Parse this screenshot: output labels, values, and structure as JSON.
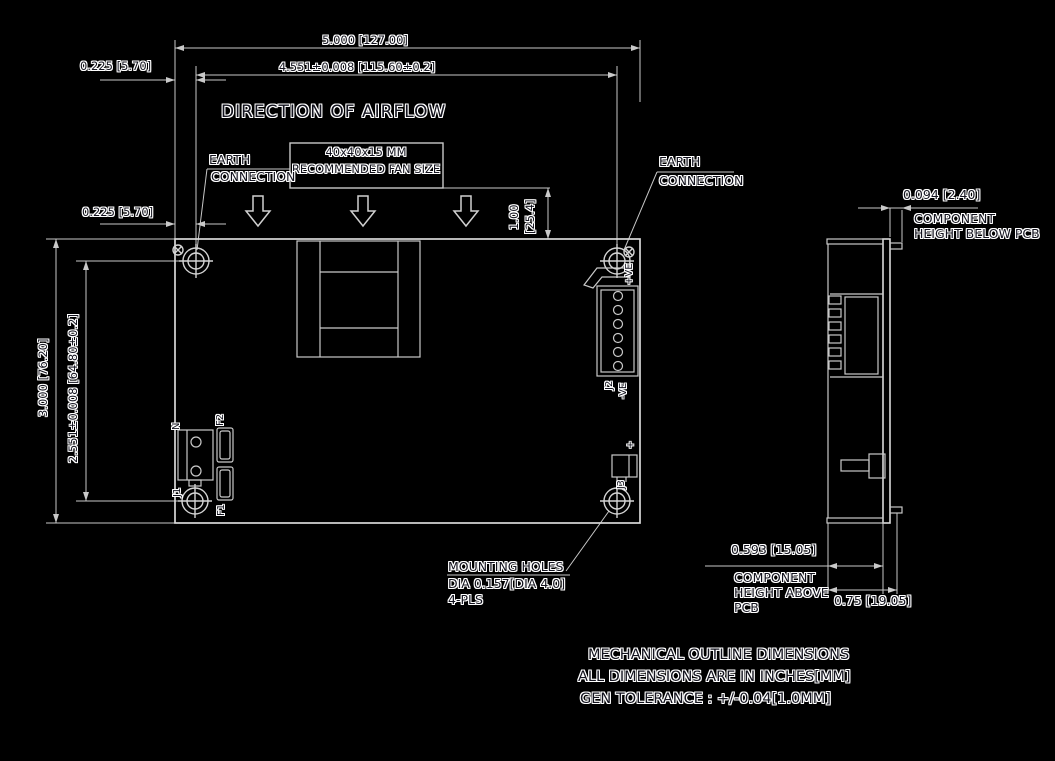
{
  "colors": {
    "background": "#000000",
    "line": "#c9c9c9",
    "outline": "#d9d9d9",
    "text_core": "#14141f",
    "text_halo": "#ffffff"
  },
  "top_view": {
    "airflow_title": "DIRECTION OF AIRFLOW",
    "fan_note": {
      "line1": "40x40x15 MM",
      "line2": "RECOMMENDED FAN SIZE"
    },
    "earth_left": {
      "line1": "EARTH",
      "line2": "CONNECTION"
    },
    "earth_right": {
      "line1": "EARTH",
      "line2": "CONNECTION"
    },
    "refdes": {
      "n": "N",
      "f1": "F1",
      "f2": "F2",
      "j1": "J1",
      "j2": "J2",
      "j3": "J3",
      "pos": "+VE",
      "neg": "-VE",
      "plus": "+"
    }
  },
  "dimensions": {
    "overall_width": "5.000 [127.00]",
    "hole_pitch_width": "4.551±0.008 [115.60±0.2]",
    "hole_offset_top": "0.225 [5.70]",
    "hole_offset_left": "0.225 [5.70]",
    "overall_height": "3.000 [76.20]",
    "hole_pitch_height": "2.551±0.008 [64.80±0.2]",
    "fan_height_in": "1.00",
    "fan_height_mm": "[25.4]",
    "height_below_pcb": "0.094 [2.40]",
    "height_above_pcb": "0.593 [15.05]",
    "overall_thickness": "0.75 [19.05]"
  },
  "callouts": {
    "height_below_label": {
      "line1": "COMPONENT",
      "line2": "HEIGHT BELOW PCB"
    },
    "height_above_label": {
      "line1": "COMPONENT",
      "line2": "HEIGHT ABOVE",
      "line3": "PCB"
    },
    "mounting_holes": {
      "line1": "MOUNTING HOLES",
      "line2": "DIA 0.157[DIA 4.0]",
      "line3": "4-PLS"
    }
  },
  "notes": {
    "line1": "MECHANICAL OUTLINE DIMENSIONS",
    "line2": "ALL DIMENSIONS ARE IN INCHES[MM]",
    "line3": "GEN TOLERANCE : +/-0.04[1.0MM]"
  }
}
